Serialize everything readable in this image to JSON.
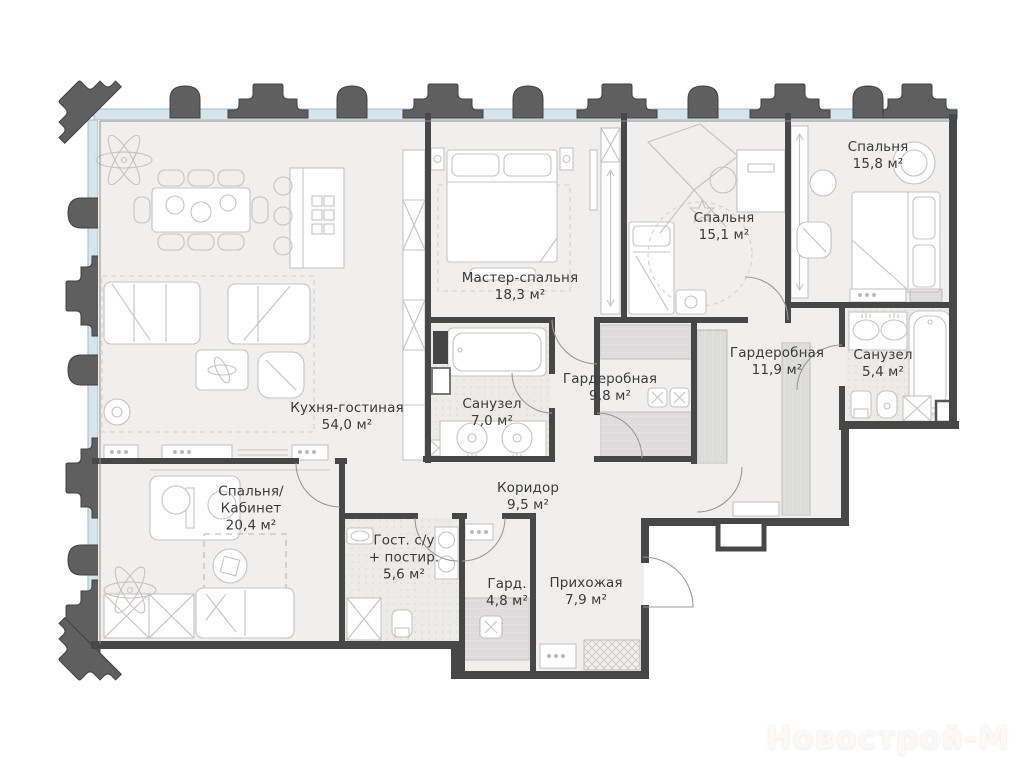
{
  "floorplan": {
    "watermark": "Новострой-М",
    "rooms": [
      {
        "name": "Кухня-гостиная",
        "area": "54,0 м²"
      },
      {
        "name": "Мастер-спальня",
        "area": "18,3 м²"
      },
      {
        "name": "Спальня",
        "area": "15,1 м²"
      },
      {
        "name": "Спальня",
        "area": "15,8 м²"
      },
      {
        "name": "Гардеробная",
        "area": "9,8 м²"
      },
      {
        "name": "Гардеробная",
        "area": "11,9 м²"
      },
      {
        "name": "Санузел",
        "area": "5,4 м²"
      },
      {
        "name": "Санузел",
        "area": "7,0 м²"
      },
      {
        "name": "Коридор",
        "area": "9,5 м²"
      },
      {
        "name": "Спальня/\nКабинет",
        "area": "20,4 м²"
      },
      {
        "name": "Гост. с/у\n+ постир.",
        "area": "5,6 м²"
      },
      {
        "name": "Гард.",
        "area": "4,8 м²"
      },
      {
        "name": "Прихожая",
        "area": "7,9 м²"
      }
    ],
    "colors": {
      "wall": "#474747",
      "floor": "#f0efee",
      "bath_floor": "#ecebe8",
      "window_band": "#d6e5ec",
      "facade_decor": "#5f5f5f",
      "furniture_line": "#c6c4c2",
      "label_text": "#3b3b3b"
    }
  }
}
